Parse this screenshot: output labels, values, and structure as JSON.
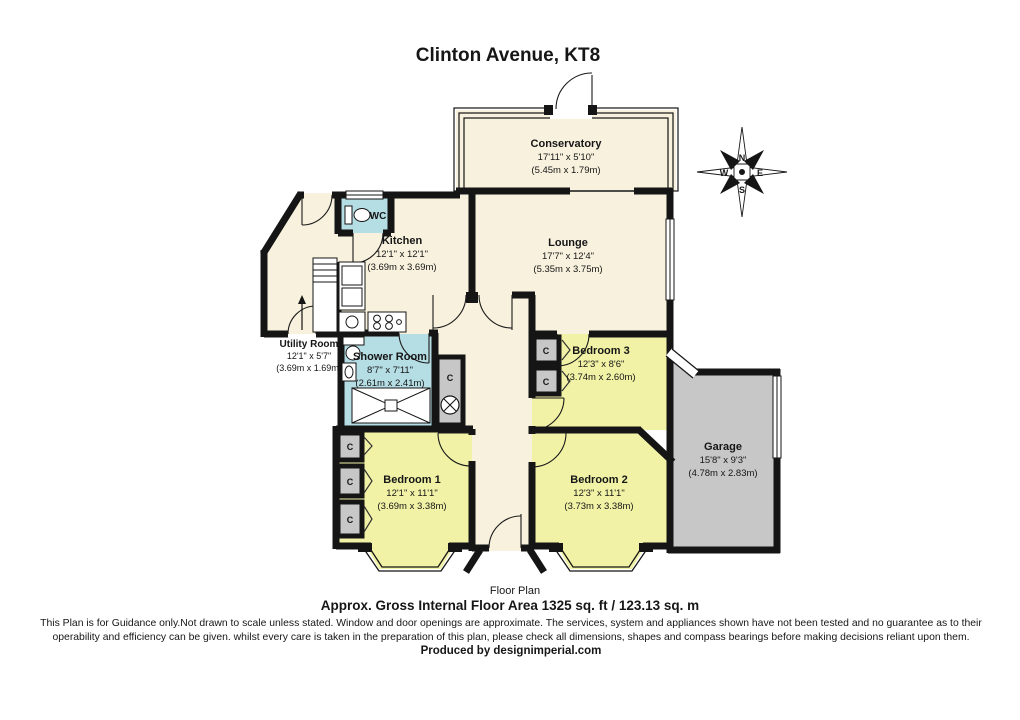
{
  "header": {
    "title": "Clinton Avenue, KT8"
  },
  "rooms": {
    "conservatory": {
      "name": "Conservatory",
      "imperial": "17'11\" x 5'10\"",
      "metric": "(5.45m x 1.79m)"
    },
    "lounge": {
      "name": "Lounge",
      "imperial": "17'7\" x 12'4\"",
      "metric": "(5.35m x 3.75m)"
    },
    "kitchen": {
      "name": "Kitchen",
      "imperial": "12'1\" x 12'1\"",
      "metric": "(3.69m x 3.69m)"
    },
    "wc": {
      "name": "WC"
    },
    "utility": {
      "name": "Utility Room",
      "imperial": "12'1\" x 5'7\"",
      "metric": "(3.69m x 1.69m)"
    },
    "shower": {
      "name": "Shower Room",
      "imperial": "8'7\" x 7'11\"",
      "metric": "(2.61m x 2.41m)"
    },
    "bedroom1": {
      "name": "Bedroom 1",
      "imperial": "12'1\" x 11'1\"",
      "metric": "(3.69m x 3.38m)"
    },
    "bedroom2": {
      "name": "Bedroom 2",
      "imperial": "12'3\" x 11'1\"",
      "metric": "(3.73m x 3.38m)"
    },
    "bedroom3": {
      "name": "Bedroom 3",
      "imperial": "12'3\" x 8'6\"",
      "metric": "(3.74m x 2.60m)"
    },
    "garage": {
      "name": "Garage",
      "imperial": "15'8\" x 9'3\"",
      "metric": "(4.78m x 2.83m)"
    },
    "cupboard": "C"
  },
  "compass": {
    "north": "N",
    "east": "E",
    "south": "S",
    "west": "W"
  },
  "footer": {
    "floor_label": "Floor Plan",
    "area_line": "Approx. Gross Internal Floor Area 1325 sq. ft /  123.13 sq. m",
    "disclaimer1": "This Plan is for Guidance only.Not drawn to scale unless stated. Window and door openings are approximate. The services, system and appliances shown have not been tested and no guarantee as to their",
    "disclaimer2": "operability and efficiency can be given. whilst every care is taken in the preparation of this plan, please check all dimensions, shapes and compass bearings before making decisions reliant upon them.",
    "credit": "Produced by designimperial.com"
  },
  "colors": {
    "wall": "#151515",
    "cream": "#f7f1dd",
    "yellow": "#f1f2a6",
    "blue": "#b5dde4",
    "gray": "#c7c7c7"
  }
}
